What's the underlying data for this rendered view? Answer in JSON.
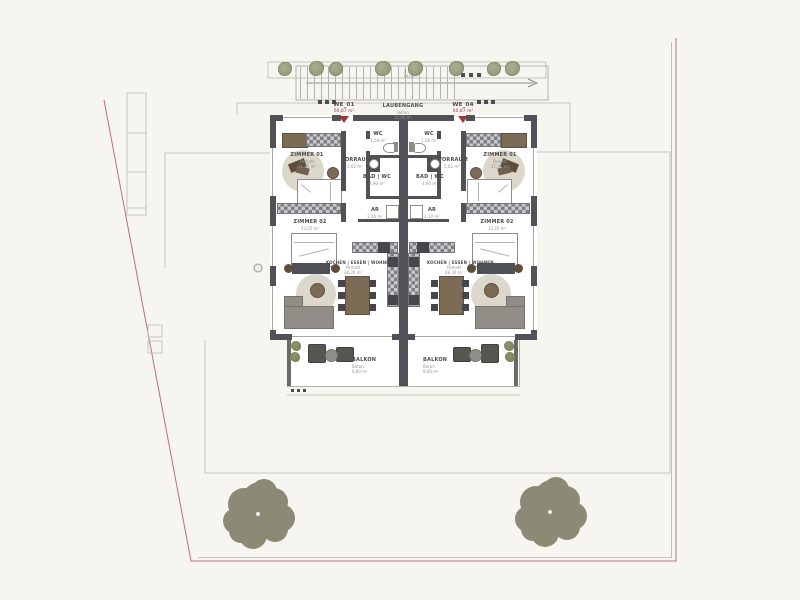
{
  "plan_type": "floor-plan-site",
  "colors": {
    "background": "#f7f5f0",
    "walls": "#515157",
    "plot_boundary": "#b4737c",
    "entrance_accent": "#993a3a",
    "vegetation": "#8c8977"
  },
  "shared": {
    "laubengang": {
      "name": "LAUBENGANG",
      "material": "Beton",
      "area": "12,40 m²"
    },
    "stairs": {
      "line1": "4 Stg",
      "line2": "16|30"
    }
  },
  "units": {
    "we01": {
      "id": "WE_01",
      "area": "60,87 m²",
      "rooms": {
        "zimmer01": {
          "name": "ZIMMER 01",
          "material": "Parkett",
          "area": "11,95 m²"
        },
        "vorraum": {
          "name": "VORRAUM",
          "material": "Fliesen",
          "area": "5,62 m²"
        },
        "wc": {
          "name": "WC",
          "area": "1,58 m²"
        },
        "bad": {
          "name": "BAD | WC",
          "material": "Fliesen",
          "area": "4,90 m²"
        },
        "ar": {
          "name": "AR",
          "area": "2,10 m²"
        },
        "zimmer02": {
          "name": "ZIMMER 02",
          "material": "Parkett",
          "area": "13,25 m²"
        },
        "wohnen": {
          "name": "KOCHEN | ESSEN | WOHNEN",
          "material": "Parkett",
          "area": "28,30 m²"
        },
        "balkon": {
          "name": "BALKON",
          "material": "Beton",
          "area": "9,60 m²"
        }
      }
    },
    "we04": {
      "id": "WE_04",
      "area": "60,87 m²",
      "rooms": {
        "zimmer01": {
          "name": "ZIMMER 01",
          "material": "Parkett",
          "area": "11,95 m²"
        },
        "vorraum": {
          "name": "VORRAUM",
          "material": "Fliesen",
          "area": "5,62 m²"
        },
        "wc": {
          "name": "WC",
          "area": "1,58 m²"
        },
        "bad": {
          "name": "BAD | WC",
          "material": "Fliesen",
          "area": "4,90 m²"
        },
        "ar": {
          "name": "AR",
          "area": "2,10 m²"
        },
        "zimmer02": {
          "name": "ZIMMER 02",
          "material": "Parkett",
          "area": "13,25 m²"
        },
        "wohnen": {
          "name": "KOCHEN | ESSEN | WOHNEN",
          "material": "Parkett",
          "area": "28,30 m²"
        },
        "balkon": {
          "name": "BALKON",
          "material": "Beton",
          "area": "9,60 m²"
        }
      }
    }
  }
}
